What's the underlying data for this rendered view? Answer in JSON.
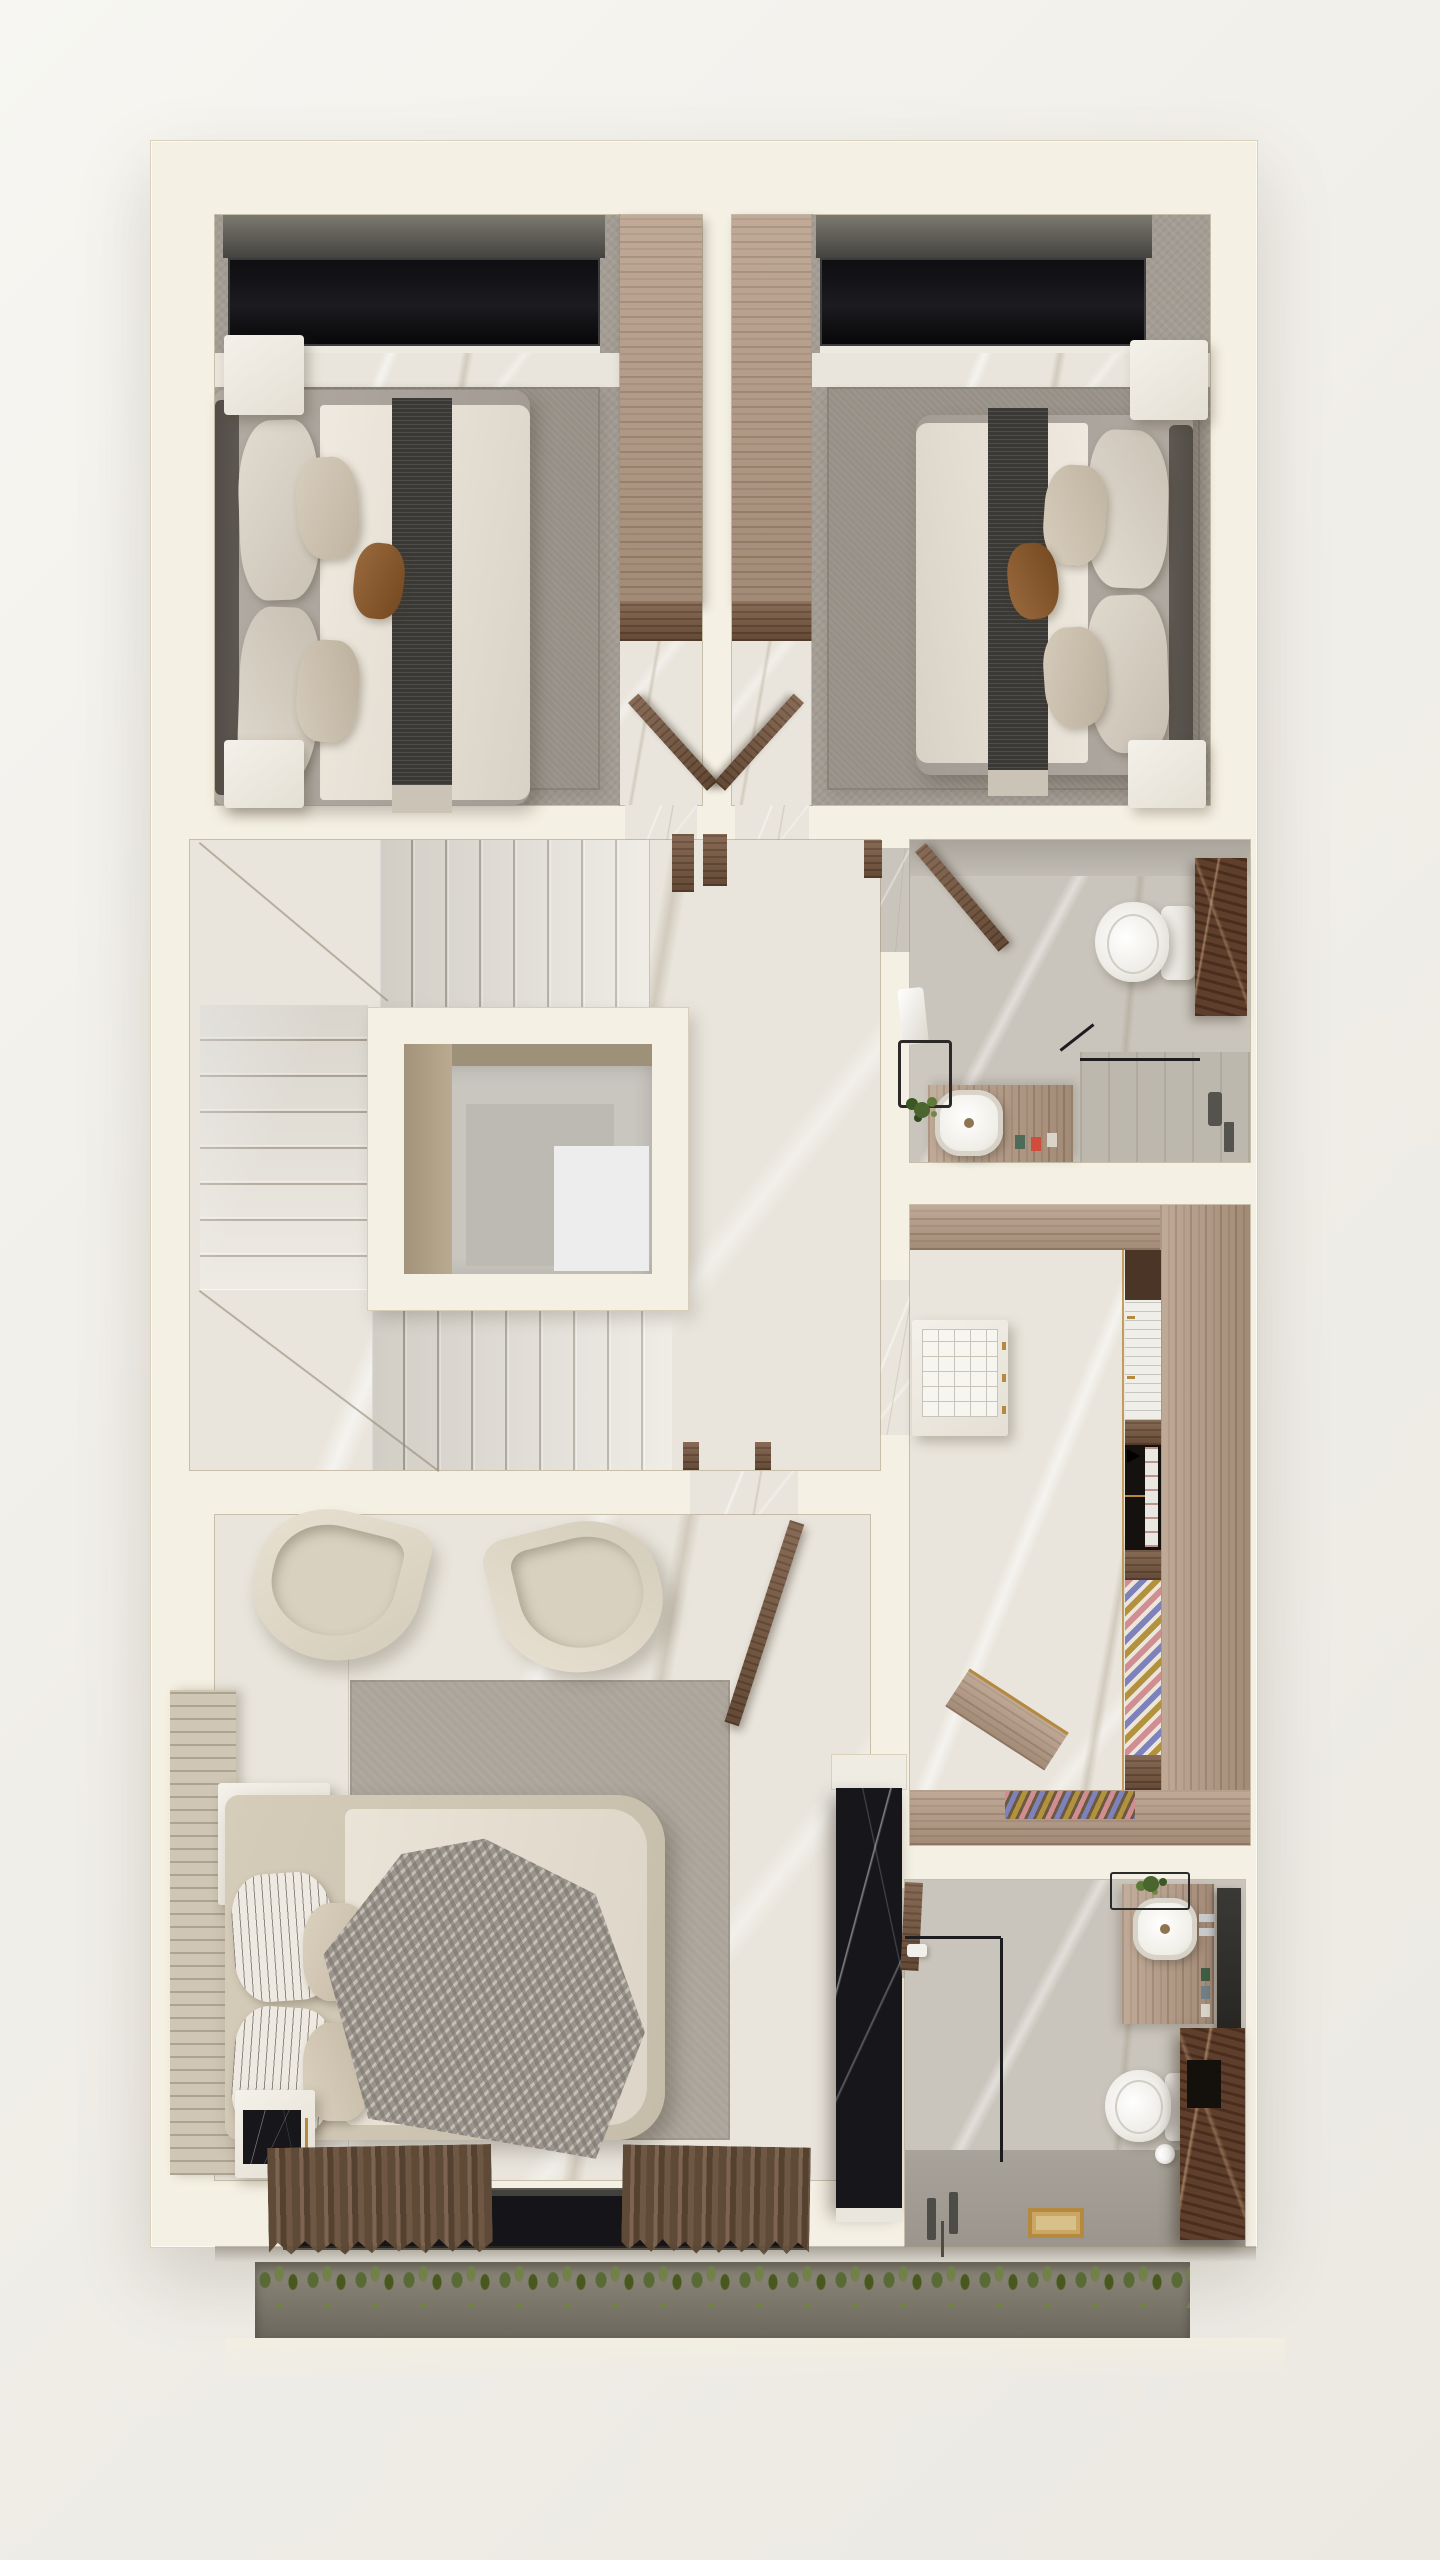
{
  "meta": {
    "title": "Upper-floor residential 3D floor plan render",
    "view": "top-down dollhouse",
    "visible_text": "none"
  },
  "palette": {
    "page_background": "#f1efe9",
    "wall_cream": "#f4f0e3",
    "wall_edge": "#d6cebb",
    "marble_floor": "#e9e5dc",
    "bath_floor": "#cac5bc",
    "carpet": "#a29c93",
    "rug": "#969087",
    "wood_light": "#b49a84",
    "wood_dark": "#7a5a42",
    "window_glazing": "#131316",
    "duvet_white": "#e7e1d7",
    "bed_runner": "#3b3936",
    "accent_pillow_brown": "#8a5c36",
    "knit_throw_gray": "#9a948c",
    "black_marble": "#17161b",
    "brown_marble": "#5f3f2b",
    "greenery": "#55703a",
    "curtain_brown": "#6a543f",
    "gold_trim": "#b68a3e"
  },
  "rooms": [
    {
      "id": "bedroom-1",
      "label": "Bedroom 1 (top left)",
      "furniture": [
        "window",
        "platform bed",
        "dark bed runner",
        "satin pillows",
        "brown accent pillow",
        "nightstand x2",
        "built-in wardrobe",
        "area rug"
      ]
    },
    {
      "id": "bedroom-2",
      "label": "Bedroom 2 (top right)",
      "furniture": [
        "window",
        "platform bed",
        "dark bed runner",
        "satin pillows",
        "brown accent pillow",
        "nightstand x2",
        "built-in wardrobe",
        "area rug"
      ]
    },
    {
      "id": "vestibule-left",
      "label": "Bedroom 1 entry with wardrobe",
      "furniture": [
        "wardrobe",
        "open door"
      ]
    },
    {
      "id": "vestibule-right",
      "label": "Bedroom 2 entry with wardrobe",
      "furniture": [
        "wardrobe",
        "open door"
      ]
    },
    {
      "id": "stair-hall",
      "label": "Stair hall with open stairwell void",
      "furniture": [
        "upper flight",
        "left flight",
        "lower flight",
        "stairwell void",
        "landing"
      ]
    },
    {
      "id": "bathroom-2",
      "label": "Guest bathroom (middle right)",
      "furniture": [
        "toilet",
        "walnut cabinet",
        "vanity with vessel sink",
        "black stool",
        "plant",
        "walk-in shower"
      ]
    },
    {
      "id": "walk-in-closet",
      "label": "Walk-in closet",
      "furniture": [
        "U-shaped wardrobe",
        "accessory island",
        "drawer niche",
        "shoe rack",
        "tie rack"
      ]
    },
    {
      "id": "master-bedroom",
      "label": "Master bedroom",
      "furniture": [
        "lounge chair x2",
        "channel headboard",
        "upholstered bed",
        "knit throw",
        "striped pillows",
        "plant console",
        "nightstand",
        "black marble media wall",
        "picture window",
        "curtains"
      ]
    },
    {
      "id": "master-bathroom",
      "label": "Master bathroom (bottom right)",
      "furniture": [
        "walk-in shower",
        "floor drain",
        "toilet",
        "vanity with vessel sink",
        "mirror",
        "brown marble tall cabinet",
        "plant basket"
      ]
    },
    {
      "id": "balcony",
      "label": "Balcony planter strip",
      "furniture": [
        "planter trough",
        "grasses"
      ]
    }
  ],
  "stairs": {
    "upper_flight_treads": 8,
    "left_flight_treads": 8,
    "lower_flight_treads": 8,
    "void_shape": "square"
  }
}
